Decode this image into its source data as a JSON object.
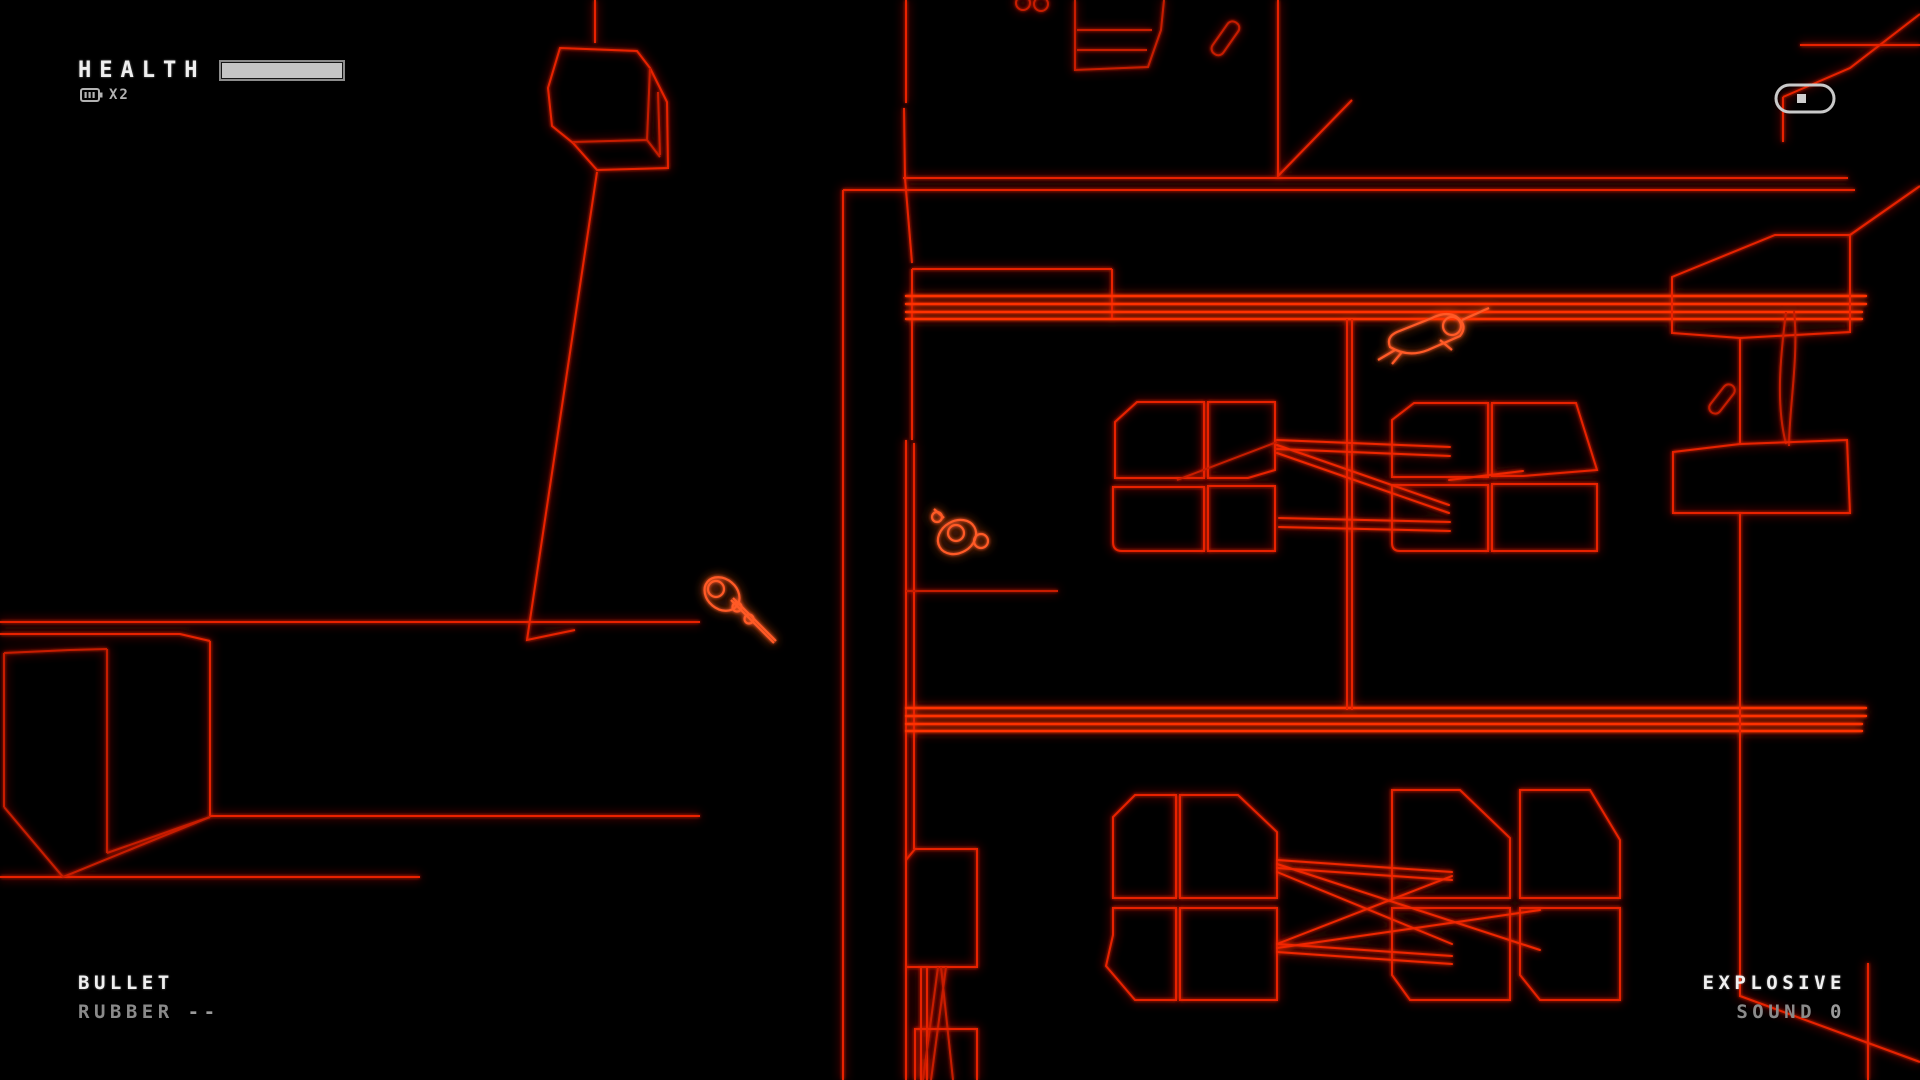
{
  "hud": {
    "health": {
      "label": "HEALTH",
      "bar_fill_percent": 100,
      "multiplier": "X2",
      "multiplier_icon": "battery-icon"
    },
    "weapon_primary": {
      "name": "BULLET",
      "mode": "RUBBER",
      "ammo": "--"
    },
    "weapon_secondary": {
      "name": "EXPLOSIVE",
      "mode": "SOUND",
      "ammo": "0"
    }
  },
  "world": {
    "marker_icon": "capsule-marker-icon",
    "entities": {
      "player": "player-character",
      "enemy_prone": "enemy-prone-top",
      "enemy_aiming": "enemy-aiming-left"
    }
  },
  "colors": {
    "background": "#000000",
    "wire": "#e82300",
    "wire_dim": "#c81e00",
    "wire_bright": "#ff5a26",
    "hud_primary": "#ededed",
    "hud_secondary": "#8a8a8a",
    "marker_grey": "#c9c9c9"
  }
}
